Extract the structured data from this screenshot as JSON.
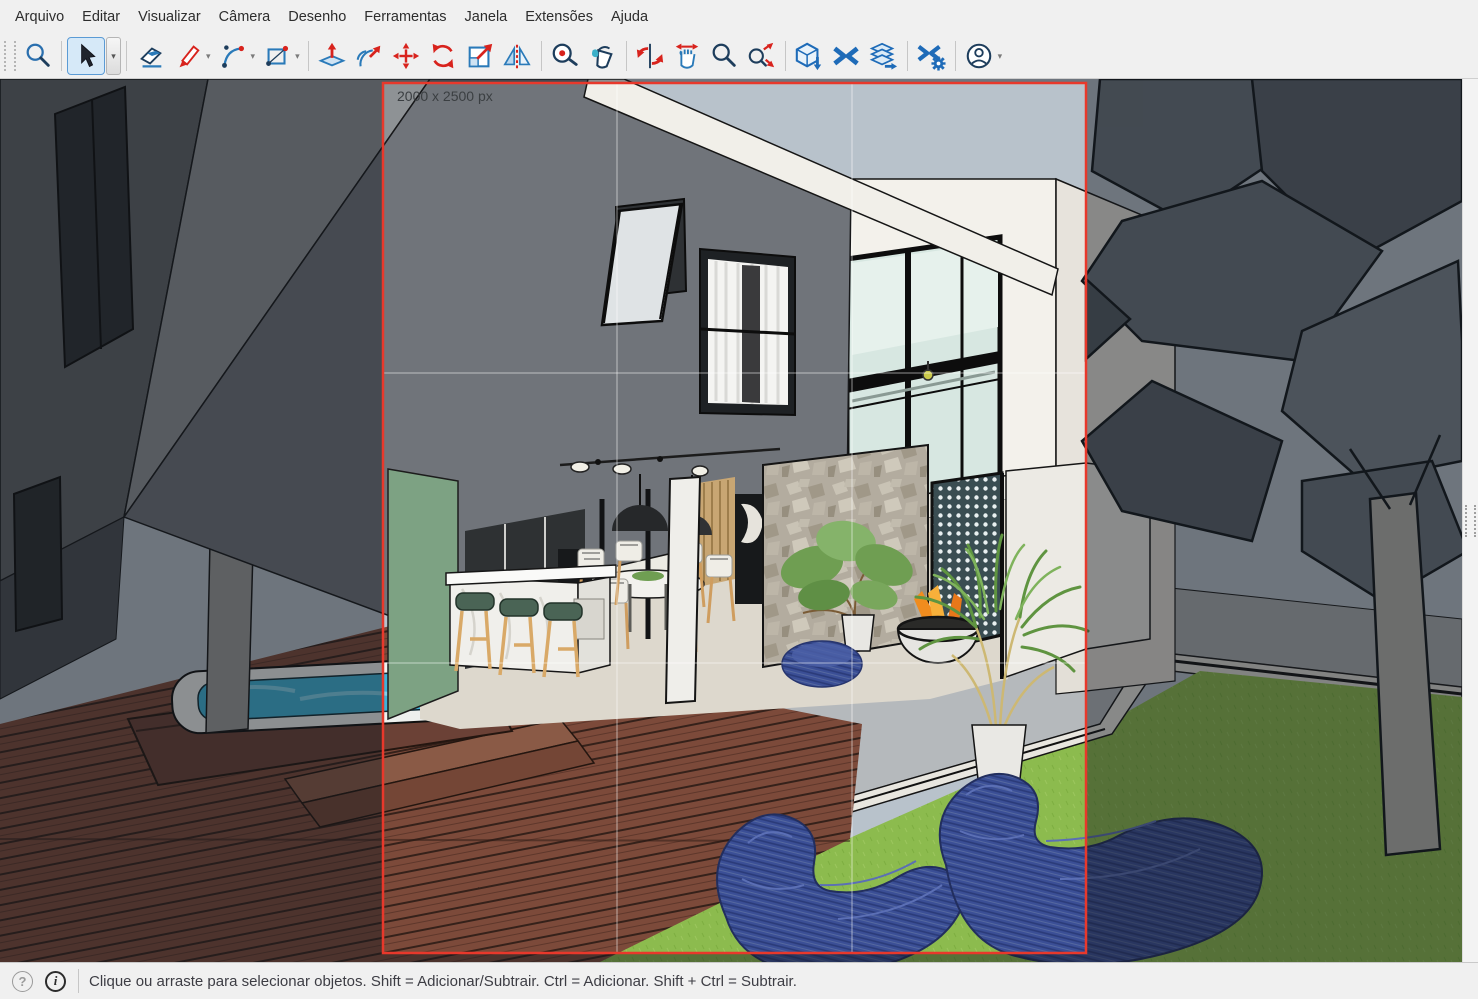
{
  "menu_bar": {
    "items": [
      "Arquivo",
      "Editar",
      "Visualizar",
      "Câmera",
      "Desenho",
      "Ferramentas",
      "Janela",
      "Extensões",
      "Ajuda"
    ]
  },
  "toolbar": {
    "active_tool": "select",
    "tools": [
      {
        "id": "search",
        "icon": "magnifier-icon"
      },
      {
        "id": "select",
        "icon": "cursor-arrow-icon",
        "active": true,
        "has_dropdown": true
      },
      {
        "id": "eraser",
        "icon": "eraser-icon"
      },
      {
        "id": "line",
        "icon": "pencil-icon",
        "has_dropdown": true
      },
      {
        "id": "arc",
        "icon": "arc-icon",
        "has_dropdown": true
      },
      {
        "id": "rectangle",
        "icon": "rectangle-icon",
        "has_dropdown": true
      },
      {
        "id": "push-pull",
        "icon": "push-pull-icon"
      },
      {
        "id": "follow-me",
        "icon": "follow-me-icon"
      },
      {
        "id": "move",
        "icon": "move-cross-icon"
      },
      {
        "id": "rotate",
        "icon": "rotate-arrows-icon"
      },
      {
        "id": "scale",
        "icon": "scale-box-icon"
      },
      {
        "id": "flip",
        "icon": "mirror-triangles-icon"
      },
      {
        "id": "tape-measure",
        "icon": "tape-measure-icon"
      },
      {
        "id": "paint-bucket",
        "icon": "paint-bucket-icon"
      },
      {
        "id": "orbit",
        "icon": "orbit-icon"
      },
      {
        "id": "pan",
        "icon": "hand-pan-icon"
      },
      {
        "id": "zoom",
        "icon": "magnifier-zoom-icon"
      },
      {
        "id": "zoom-extents",
        "icon": "magnifier-extents-icon"
      },
      {
        "id": "warehouse-3d",
        "icon": "warehouse-box-icon"
      },
      {
        "id": "trimble-connect",
        "icon": "connect-x-icon"
      },
      {
        "id": "send-to-layout",
        "icon": "layout-stack-icon"
      },
      {
        "id": "extension-manager",
        "icon": "extension-gear-icon"
      },
      {
        "id": "account",
        "icon": "user-circle-icon",
        "has_dropdown": true
      }
    ]
  },
  "viewport": {
    "export_label": "2000 x 2500 px",
    "export_border_color": "#e8382b",
    "grid_overlay": "rule-of-thirds"
  },
  "status_bar": {
    "icons": [
      "help-circle",
      "info-circle"
    ],
    "message": "Clique ou arraste para selecionar objetos. Shift = Adicionar/Subtrair. Ctrl = Adicionar. Shift + Ctrl = Subtrair."
  },
  "scene": {
    "description": "modern two-story house with patio, deck, hot tub, lawn and large tree",
    "colors": {
      "sky": "#b8c2cb",
      "dark_facade": "#70747a",
      "white_walls": "#f2f0ea",
      "glass": "#d7e7e1",
      "stone_wall": "#b3ac9f",
      "green_wall": "#7da283",
      "lawn": "#8cbb4e",
      "deck": "#7c4a3a",
      "patio": "#b5b9bc",
      "water": "#3fb2d8",
      "lounge_chairs": "#3b4f96",
      "fire": "#f08c1e",
      "foliage": "#6f9e52"
    }
  }
}
